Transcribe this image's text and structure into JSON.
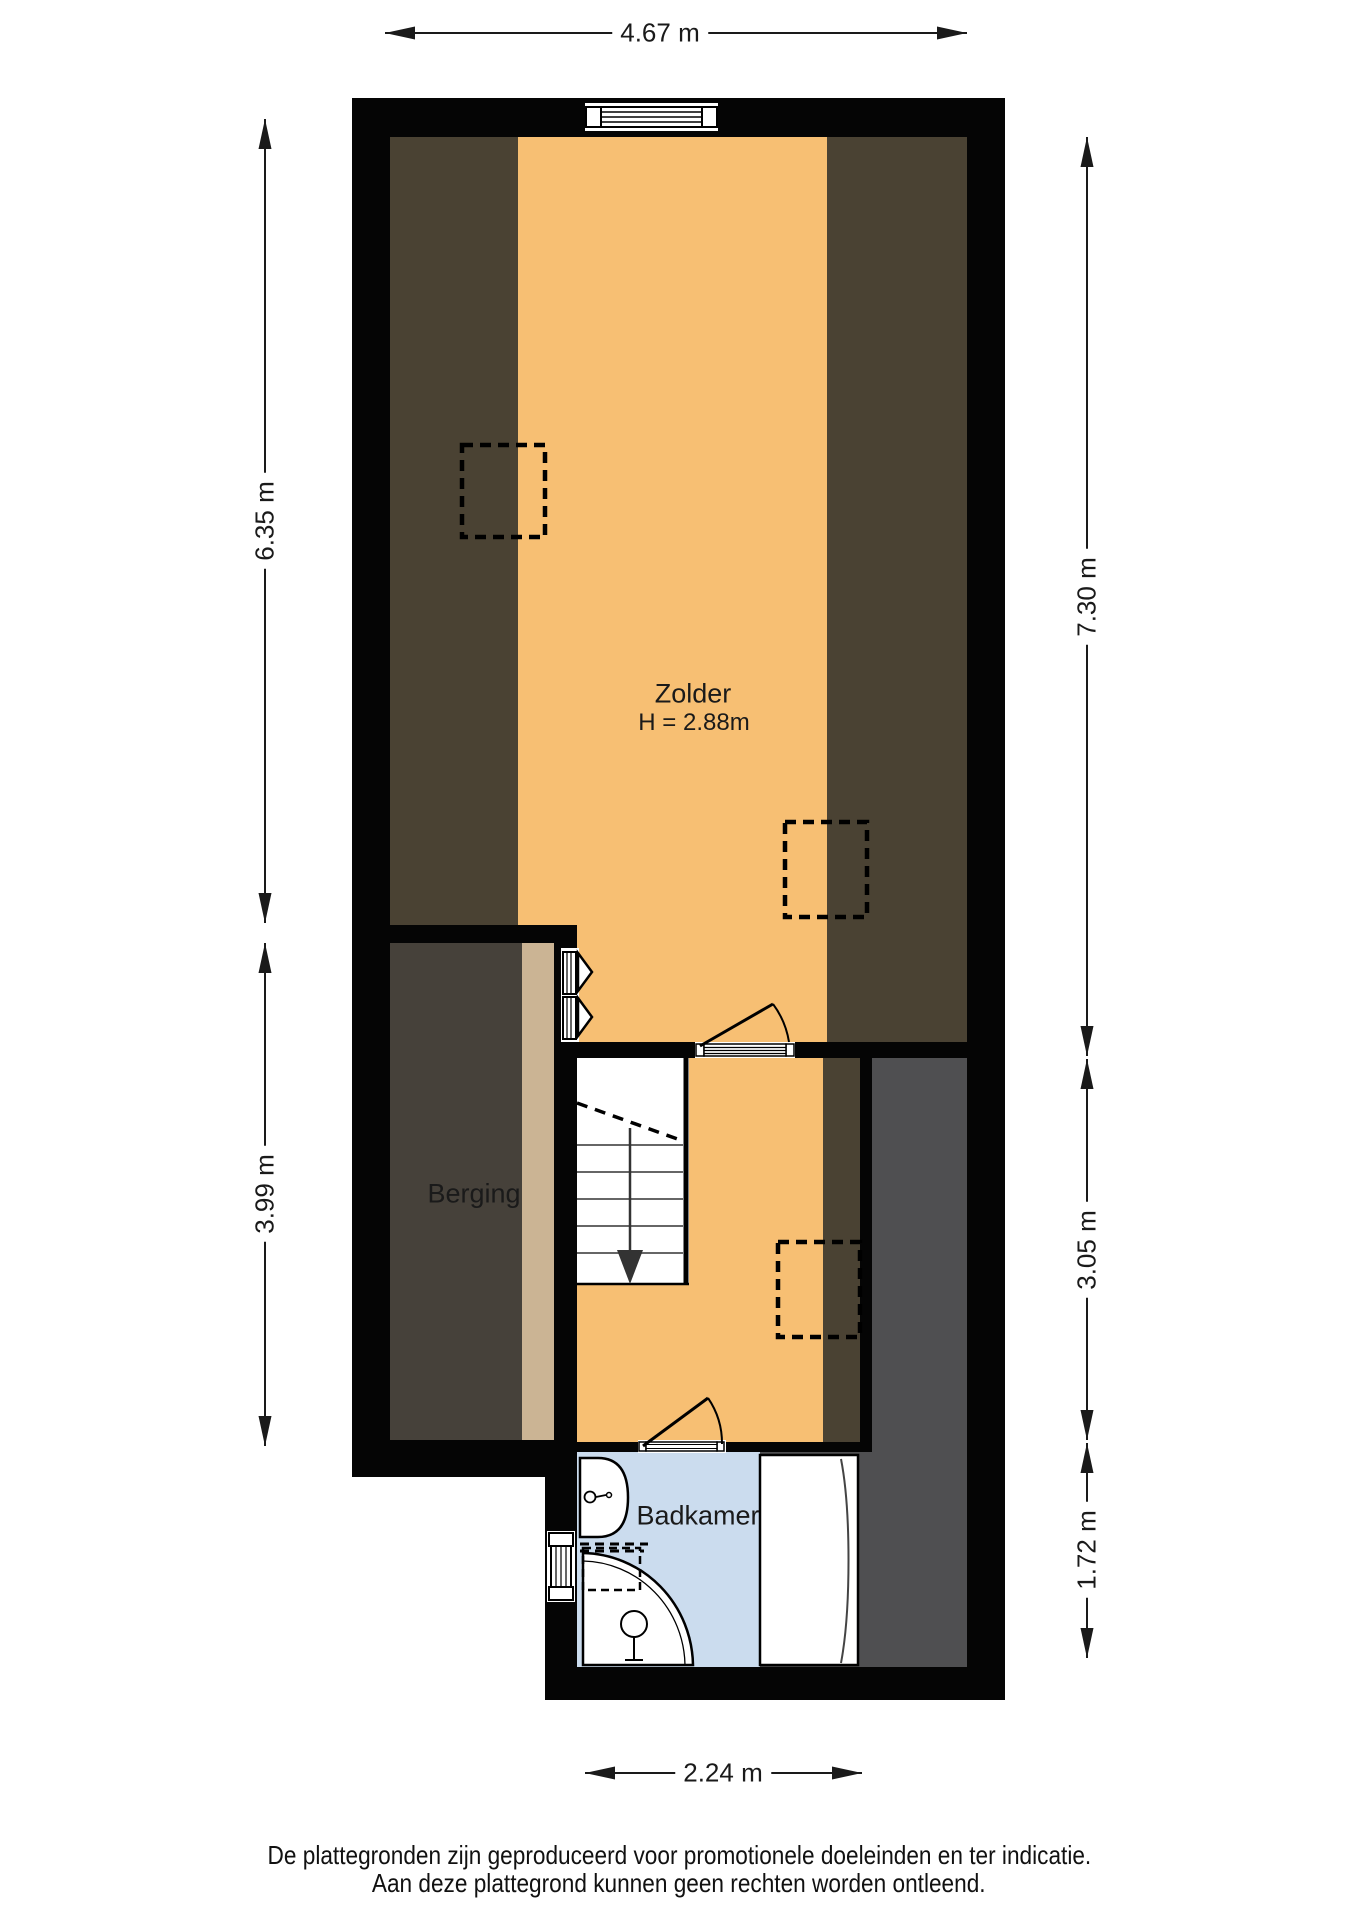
{
  "rooms": {
    "zolder": {
      "label": "Zolder",
      "height_label": "H = 2.88m"
    },
    "berging": {
      "label": "Berging"
    },
    "badkamer": {
      "label": "Badkamer"
    }
  },
  "dimensions": {
    "top": "4.67 m",
    "left_upper": "6.35 m",
    "left_lower": "3.99 m",
    "right_upper": "7.30 m",
    "right_middle": "3.05 m",
    "right_lower": "1.72 m",
    "bottom": "2.24 m"
  },
  "disclaimer": {
    "line1": "De plattegronden zijn geproduceerd voor promotionele doeleinden en ter indicatie.",
    "line2": "Aan deze plattegrond kunnen geen rechten worden ontleend."
  },
  "colors": {
    "floor_orange": "#F7BF73",
    "roof_band_brown": "#4A4233",
    "storage_gray": "#46413A",
    "storage_tan": "#CBB494",
    "side_gray": "#4F4F51",
    "bathroom_blue": "#CBDCEE",
    "wall_black": "#050505"
  }
}
